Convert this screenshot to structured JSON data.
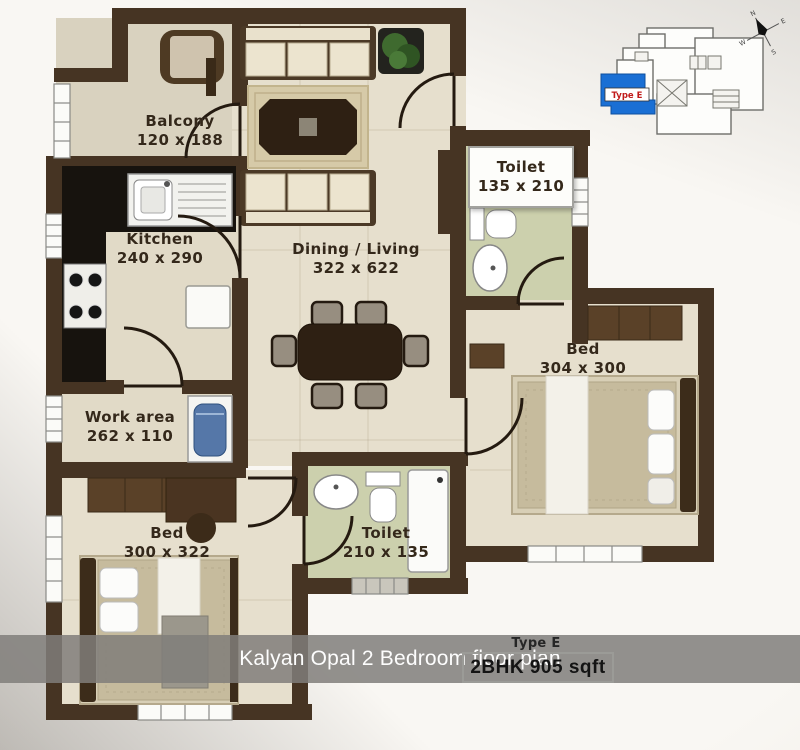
{
  "caption": {
    "text": "Kalyan Opal 2 Bedroom floor plan"
  },
  "unit": {
    "type_label": "Type E",
    "spec": "2BHK 905 sqft"
  },
  "keyplan": {
    "highlight_label": "Type E",
    "highlight_color": "#1a6fd4"
  },
  "compass": {
    "points": [
      "N",
      "E",
      "S",
      "W"
    ]
  },
  "rooms": [
    {
      "name": "Balcony",
      "dims": "120 x 188"
    },
    {
      "name": "Kitchen",
      "dims": "240 x 290"
    },
    {
      "name": "Dining / Living",
      "dims": "322 x 622"
    },
    {
      "name": "Toilet",
      "dims": "135 x 210"
    },
    {
      "name": "Bed",
      "dims": "304 x 300"
    },
    {
      "name": "Work area",
      "dims": "262 x 110"
    },
    {
      "name": "Bed",
      "dims": "300 x 322"
    },
    {
      "name": "Toilet",
      "dims": "210 x 135"
    }
  ],
  "colors": {
    "wall": "#463423",
    "floor": "#e4ddcb",
    "toilet_floor": "#ccd0ad",
    "counter": "#17130e",
    "caption_bg": "rgba(128,126,122,0.85)"
  }
}
